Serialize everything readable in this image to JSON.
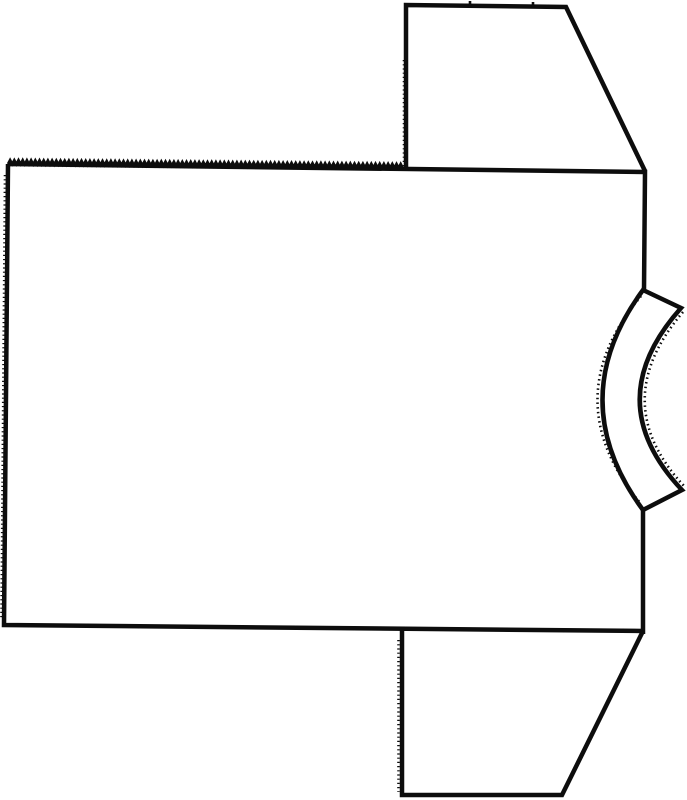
{
  "meta": {
    "description": "Black-and-white line drawing: sewing pattern layout of a short-sleeved T-shirt shown sideways — large body panel with pinked top edge, two trapezoidal sleeve pieces at right top and bottom, and a curved neckband piece notched into the right side"
  },
  "canvas": {
    "width": 687,
    "height": 800,
    "viewbox": "0 0 687 800",
    "background": "#ffffff"
  },
  "style": {
    "ink": "#0d0d0d",
    "main_stroke_width": 4.5,
    "decoration_stroke_width": 2.6,
    "fuzz_dash": "1.5 3.2",
    "dot_dash": "1.2 3"
  },
  "shapes": {
    "body_panel": {
      "label": "body panel",
      "path": "M 8 164 L 645 172 L 644 290 M 643 510 L 643 634 M 643 631 L 4 625 L 8 164"
    },
    "top_sleeve": {
      "label": "sleeve piece top",
      "path": "M 406 168 L 406 5 L 566 7 L 645 171"
    },
    "bottom_sleeve": {
      "label": "sleeve piece bottom",
      "path": "M 402 629 L 402 795 L 562 795 L 643 631"
    },
    "neckband": {
      "label": "curved neckband piece",
      "path": "M 643 290 L 681 308 Q 598 401 682 490 L 643 510 Q 562 400 643 290 Z"
    }
  },
  "decorations": {
    "pinked_edge": {
      "x1": 8,
      "y1": 164,
      "x2": 406,
      "y2": 168,
      "period": 4.2,
      "amplitude": 4
    },
    "sleeve_notches_path": "M 470 8 L 470 1 M 533 8 L 533 2",
    "neckband_fuzz_outer_path": "M 641 296 Q 554 400 641 504",
    "neckband_fuzz_inner_path": "M 683 312 Q 606 402 684 486",
    "dotted_edges_path": "M 404 60 L 404 166 M 398.5 640 L 398.5 792 M 5 175 L 1.5 618"
  }
}
